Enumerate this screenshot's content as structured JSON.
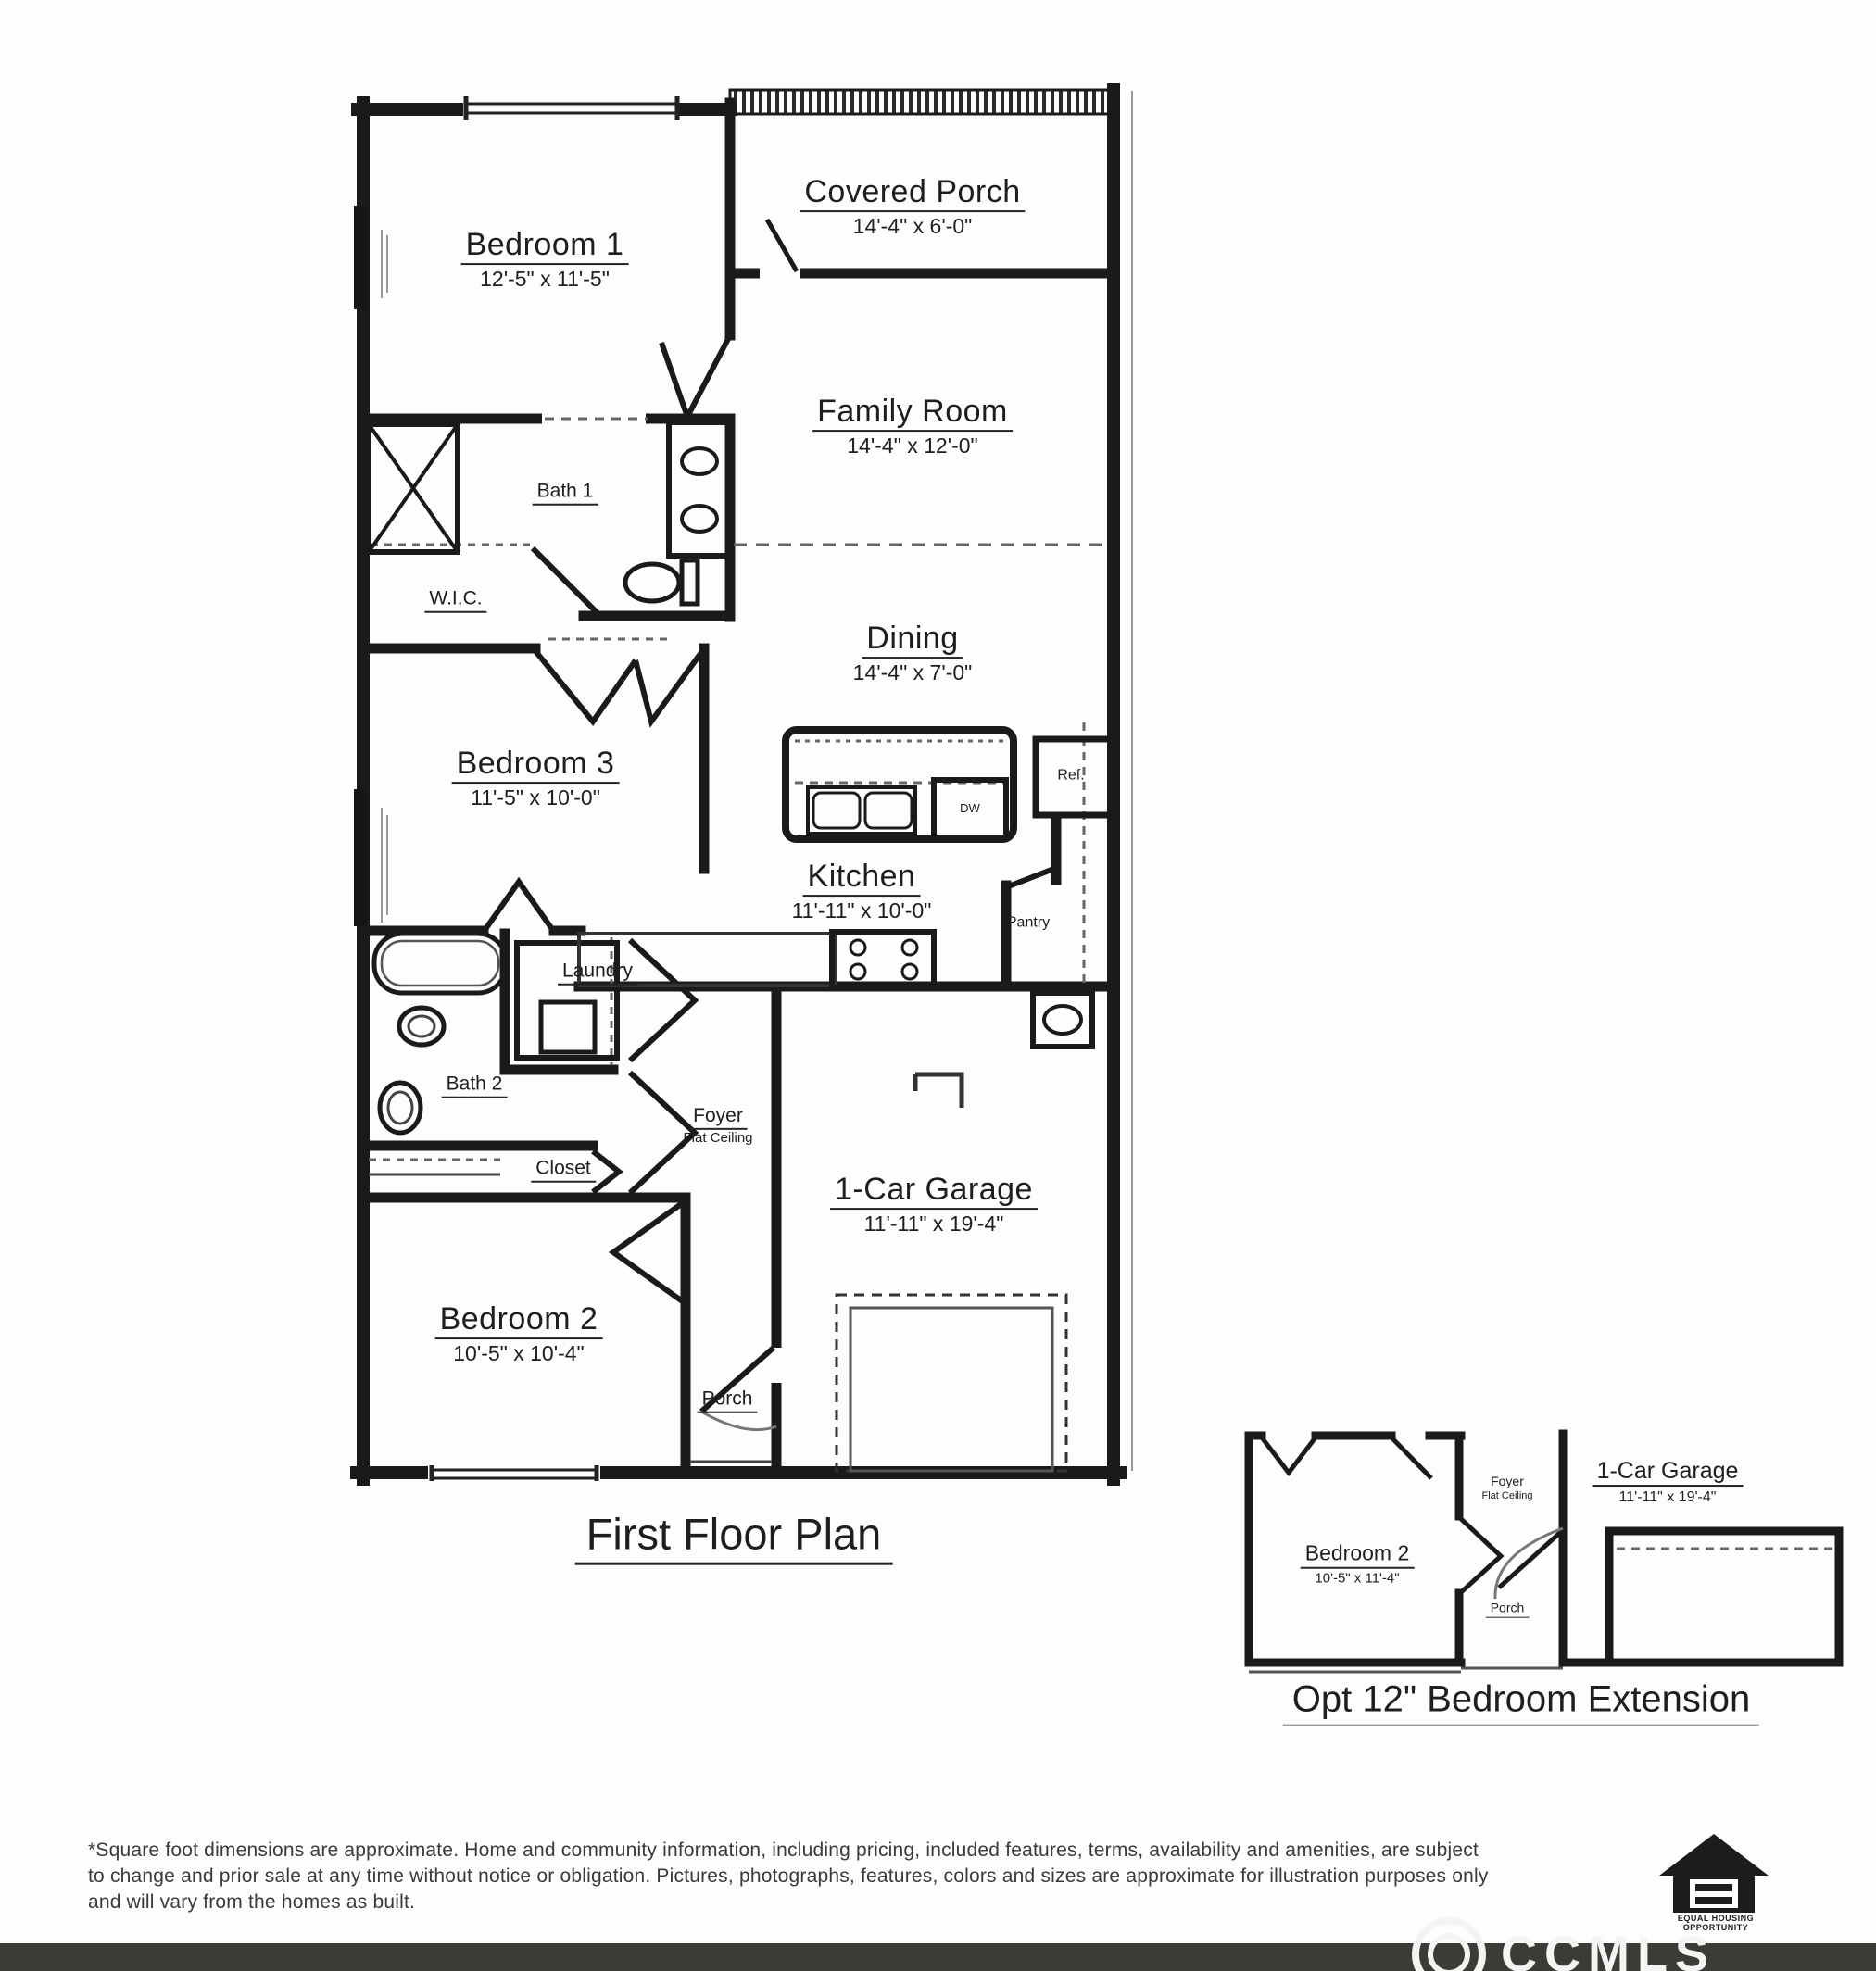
{
  "main_plan": {
    "title": "First Floor Plan",
    "rooms": {
      "covered_porch": {
        "name": "Covered Porch",
        "dims": "14'-4\" x 6'-0\""
      },
      "bedroom1": {
        "name": "Bedroom 1",
        "dims": "12'-5\" x 11'-5\""
      },
      "family_room": {
        "name": "Family Room",
        "dims": "14'-4\" x 12'-0\""
      },
      "bath1": {
        "name": "Bath 1"
      },
      "wic": {
        "name": "W.I.C."
      },
      "dining": {
        "name": "Dining",
        "dims": "14'-4\" x 7'-0\""
      },
      "bedroom3": {
        "name": "Bedroom 3",
        "dims": "11'-5\" x 10'-0\""
      },
      "kitchen": {
        "name": "Kitchen",
        "dims": "11'-11\" x 10'-0\""
      },
      "refrigerator": {
        "name": "Ref."
      },
      "dishwasher": {
        "name": "DW"
      },
      "pantry": {
        "name": "Pantry"
      },
      "laundry": {
        "name": "Laundry"
      },
      "bath2": {
        "name": "Bath 2"
      },
      "foyer": {
        "name": "Foyer",
        "sub": "Flat Ceiling"
      },
      "closet": {
        "name": "Closet"
      },
      "bedroom2": {
        "name": "Bedroom 2",
        "dims": "10'-5\" x 10'-4\""
      },
      "porch": {
        "name": "Porch"
      },
      "garage": {
        "name": "1-Car Garage",
        "dims": "11'-11\" x 19'-4\""
      }
    }
  },
  "option_plan": {
    "title": "Opt 12\" Bedroom Extension",
    "rooms": {
      "bedroom2": {
        "name": "Bedroom 2",
        "dims": "10'-5\" x 11'-4\""
      },
      "foyer": {
        "name": "Foyer",
        "sub": "Flat Ceiling"
      },
      "porch": {
        "name": "Porch"
      },
      "garage": {
        "name": "1-Car Garage",
        "dims": "11'-11\" x 19'-4\""
      }
    }
  },
  "footer": {
    "disclaimer": {
      "line1": "*Square foot dimensions are approximate. Home and community information, including pricing, included features, terms, availability and amenities, are subject",
      "line2": "to change and prior sale at any time without notice or obligation. Pictures, photographs, features, colors and sizes are approximate for illustration purposes only",
      "line3": "and will vary from the homes as built."
    },
    "equal_housing": {
      "line1": "EQUAL HOUSING",
      "line2": "OPPORTUNITY"
    },
    "watermark": "CCMLS"
  }
}
